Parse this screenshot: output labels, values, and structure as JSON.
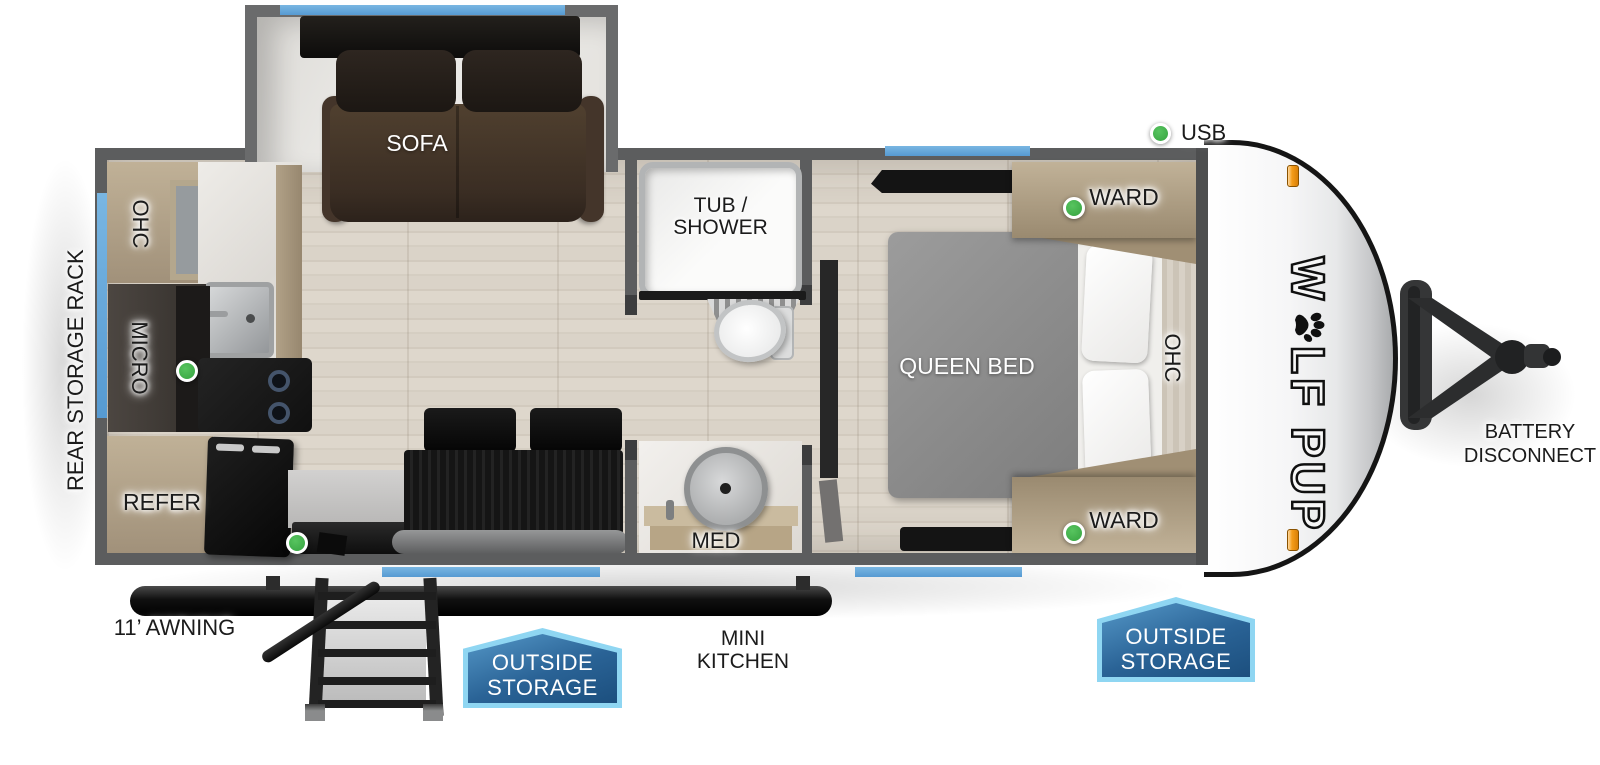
{
  "title": "Wolf Pup travel trailer floorplan",
  "legend": {
    "usb": "USB"
  },
  "exterior": {
    "rear_storage_rack": "REAR STORAGE RACK",
    "awning": "11’ AWNING",
    "mini_kitchen": [
      "MINI",
      "KITCHEN"
    ],
    "battery": [
      "BATTERY",
      "DISCONNECT"
    ],
    "outside_storage": [
      "OUTSIDE",
      "STORAGE"
    ]
  },
  "brand": {
    "logo_start": "W",
    "logo_end": "LF PUP",
    "paw_icon": "paw-print"
  },
  "living": {
    "sofa": "SOFA",
    "ohc": "OHC",
    "micro": "MICRO",
    "refer": "REFER"
  },
  "bath": {
    "tub": [
      "TUB /",
      "SHOWER"
    ],
    "med": "MED"
  },
  "bedroom": {
    "bed": "QUEEN BED",
    "ward": "WARD",
    "ohc": "OHC"
  },
  "colors": {
    "window_blue": "#64a7da",
    "badge_blue": "#2a6396",
    "badge_border": "#8fd6f2",
    "indicator_green": "#3fae49",
    "clearance_orange": "#f59d1a",
    "wall_gray": "#5c5d5e"
  }
}
